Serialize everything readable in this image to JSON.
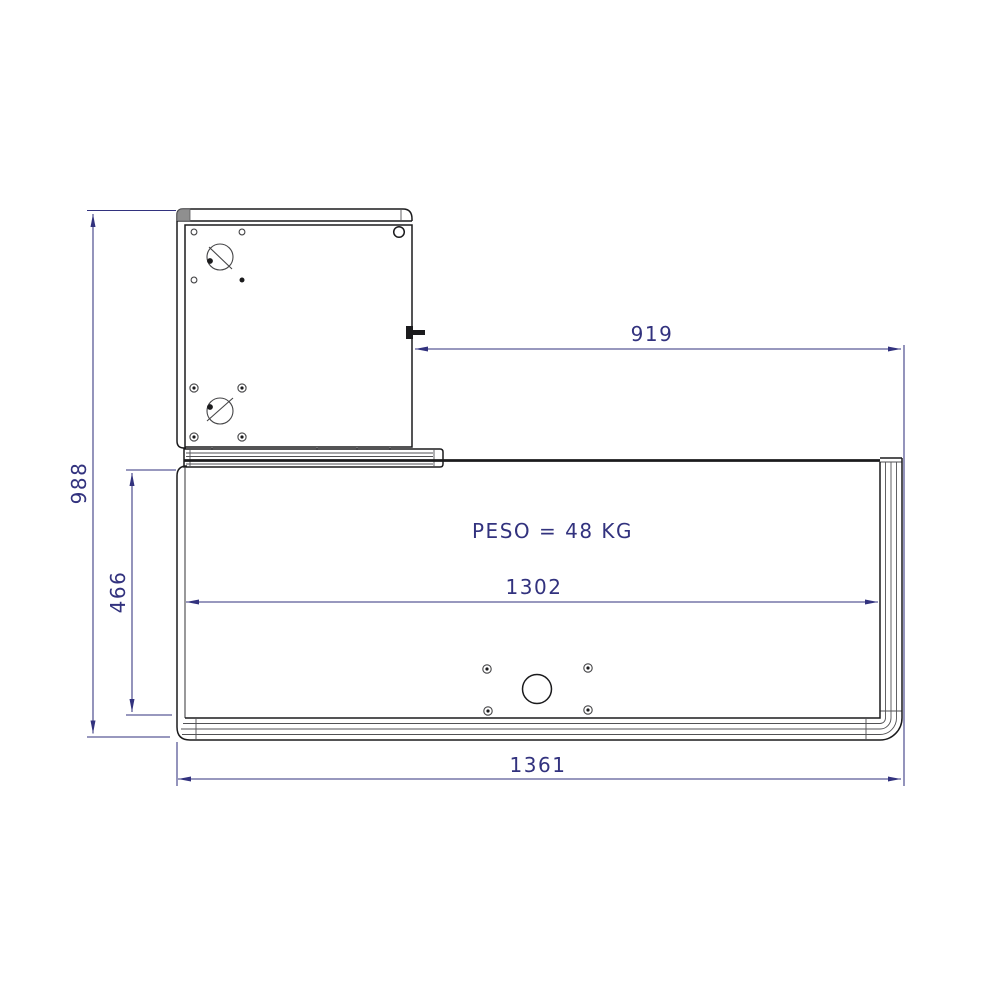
{
  "theme": {
    "dim": "#32327e",
    "ink": "#1b1b1d",
    "metal": "#8f8f8f",
    "paper": "#ffffff"
  },
  "drawing": {
    "weight_label": "PESO = 48 KG",
    "dims": {
      "overall_height": "988",
      "panel_height": "466",
      "top_offset_width": "919",
      "inner_width": "1302",
      "overall_width": "1361"
    }
  }
}
